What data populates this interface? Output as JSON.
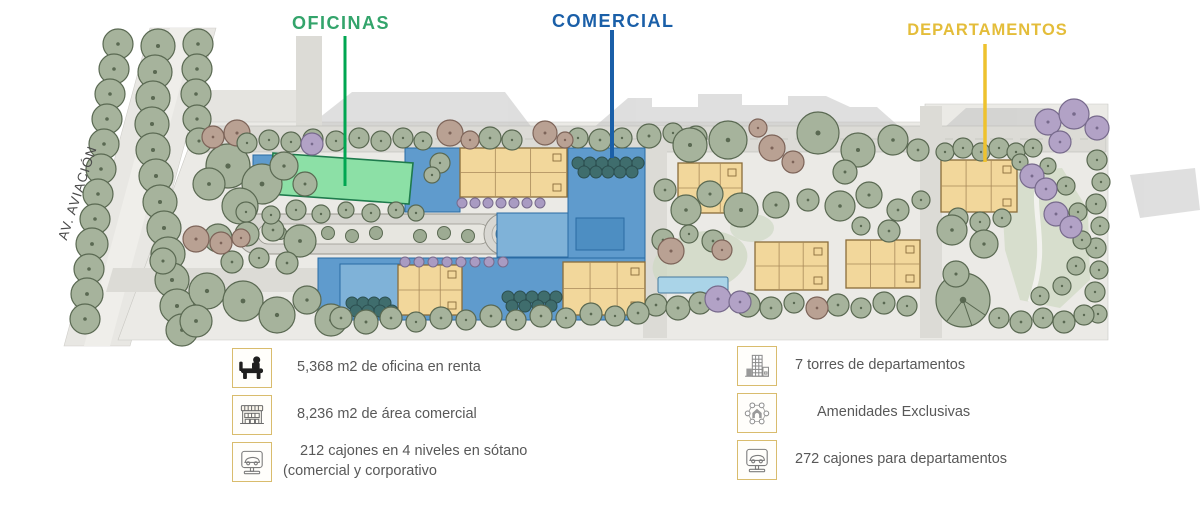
{
  "plan": {
    "street_label": "AV. AVIACIÓN",
    "annotations": [
      {
        "id": "oficinas",
        "label": "OFICINAS",
        "color": "#33a46b",
        "leader_color": "#00a651"
      },
      {
        "id": "comercial",
        "label": "COMERCIAL",
        "color": "#1a5fa8",
        "leader_color": "#1a5fa8"
      },
      {
        "id": "departamentos",
        "label": "DEPARTAMENTOS",
        "color": "#e4bd3a",
        "leader_color": "#eec22e"
      }
    ],
    "zone_fill_colors": {
      "oficinas": "#8ce0a6",
      "comercial": "#5f9bcd",
      "departamentos": "#f2d79b"
    }
  },
  "legend": {
    "columns": [
      {
        "items": [
          {
            "icon": "office-desk-icon",
            "text": "5,368 m2 de oficina en renta"
          },
          {
            "icon": "storefront-icon",
            "text": "8,236 m2 de área comercial"
          },
          {
            "icon": "parking-car-icon",
            "text": "212 cajones en 4 niveles en sótano",
            "text2": "(comercial y corporativo"
          }
        ]
      },
      {
        "items": [
          {
            "icon": "apartment-towers-icon",
            "text": "7 torres de departamentos"
          },
          {
            "icon": "amenities-icon",
            "text": "Amenidades Exclusivas"
          },
          {
            "icon": "parking-car-icon",
            "text": "272 cajones para departamentos"
          }
        ]
      }
    ]
  }
}
